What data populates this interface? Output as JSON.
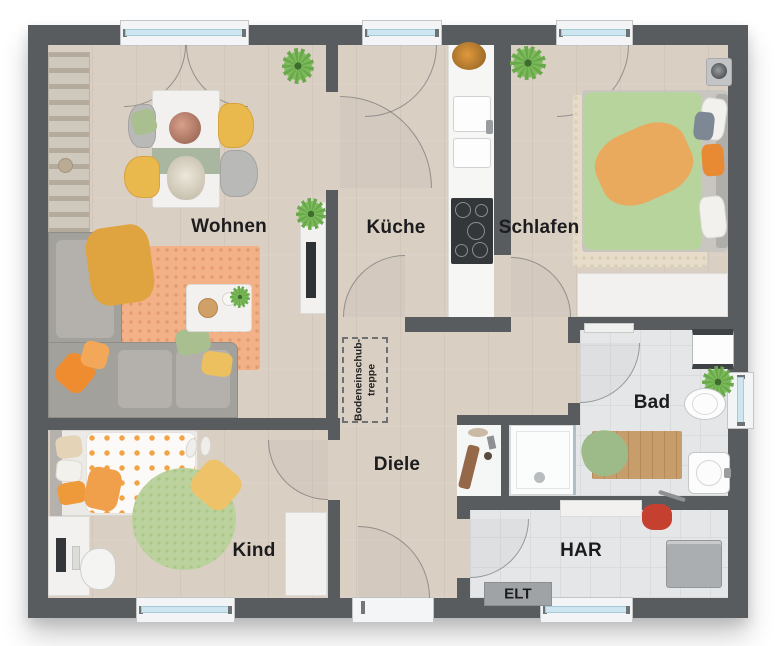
{
  "rooms": {
    "wohnen": {
      "label": "Wohnen"
    },
    "kueche": {
      "label": "Küche"
    },
    "schlafen": {
      "label": "Schlafen"
    },
    "bad": {
      "label": "Bad"
    },
    "diele": {
      "label": "Diele"
    },
    "kind": {
      "label": "Kind"
    },
    "har": {
      "label": "HAR"
    },
    "elt": {
      "label": "ELT"
    }
  },
  "annotations": {
    "attic_stairs": {
      "line1": "Bodeneinschub-",
      "line2": "treppe"
    }
  },
  "colors": {
    "wall": "#595c5f",
    "wood_floor": "#d9cfc3",
    "tile_floor": "#e4e6e7",
    "window_glass": "#cde6f0",
    "accent_orange": "#ef8c2f",
    "accent_green": "#a9bf90",
    "accent_yellow": "#ecc05e",
    "accent_red": "#c5402f"
  }
}
